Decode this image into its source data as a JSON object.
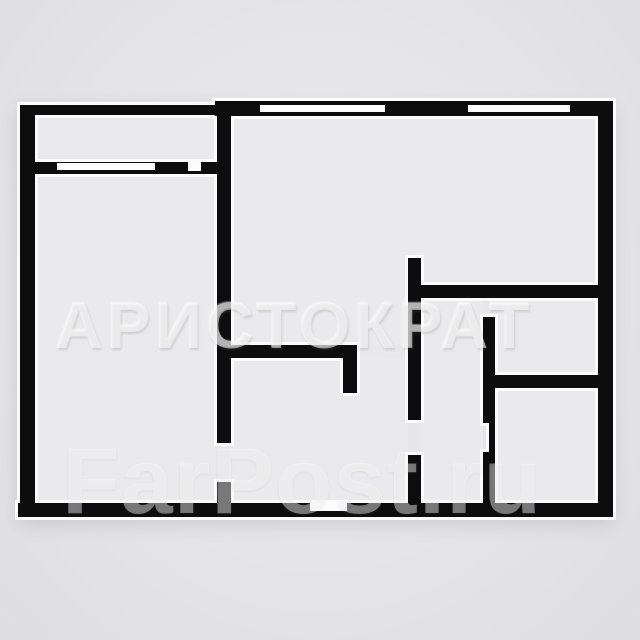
{
  "colors": {
    "page_bg": "#e4e4e6",
    "room_fill": "#eaeaec",
    "wall": "#0d0d0d",
    "halo": "#fbfbfc",
    "opening_fill": "#fcfcfd"
  },
  "watermarks": {
    "brand": "АРИСТОКРАТ",
    "site": "FarPost.ru"
  },
  "floorplan": {
    "rooms": [
      {
        "name": "room-balcony",
        "x": 35,
        "y": 115,
        "w": 183,
        "h": 47
      },
      {
        "name": "room-left",
        "x": 34,
        "y": 174,
        "w": 183,
        "h": 329
      },
      {
        "name": "room-living-top",
        "x": 231,
        "y": 116,
        "w": 367,
        "h": 170
      },
      {
        "name": "room-living-left",
        "x": 231,
        "y": 116,
        "w": 177,
        "h": 229
      },
      {
        "name": "room-corridor",
        "x": 231,
        "y": 358,
        "w": 177,
        "h": 145
      },
      {
        "name": "room-inner-hall",
        "x": 421,
        "y": 297,
        "w": 62,
        "h": 206
      },
      {
        "name": "room-bathroom",
        "x": 495,
        "y": 297,
        "w": 103,
        "h": 78
      },
      {
        "name": "room-bottom-right",
        "x": 495,
        "y": 388,
        "w": 103,
        "h": 115
      }
    ],
    "walls": [
      {
        "name": "balcony-parapet-wall",
        "x": 22,
        "y": 105,
        "w": 196,
        "h": 10
      },
      {
        "name": "left-outer-wall",
        "x": 20,
        "y": 105,
        "w": 15,
        "h": 412
      },
      {
        "name": "balcony-inner-wall",
        "x": 22,
        "y": 162,
        "w": 196,
        "h": 12
      },
      {
        "name": "top-outer-wall",
        "x": 215,
        "y": 101,
        "w": 398,
        "h": 15
      },
      {
        "name": "right-outer-wall",
        "x": 598,
        "y": 101,
        "w": 15,
        "h": 416
      },
      {
        "name": "bottom-outer-wall",
        "x": 18,
        "y": 503,
        "w": 595,
        "h": 14
      },
      {
        "name": "center-wall-upper",
        "x": 217,
        "y": 115,
        "w": 14,
        "h": 328
      },
      {
        "name": "center-wall-lower",
        "x": 217,
        "y": 482,
        "w": 14,
        "h": 28
      },
      {
        "name": "corridor-wall-horizontal",
        "x": 231,
        "y": 345,
        "w": 126,
        "h": 13
      },
      {
        "name": "corridor-wall-return",
        "x": 343,
        "y": 358,
        "w": 14,
        "h": 35
      },
      {
        "name": "inner-wall-right-upper",
        "x": 408,
        "y": 258,
        "w": 13,
        "h": 162
      },
      {
        "name": "inner-wall-right-lower",
        "x": 408,
        "y": 455,
        "w": 13,
        "h": 52
      },
      {
        "name": "bathroom-wall-top",
        "x": 415,
        "y": 285,
        "w": 184,
        "h": 13
      },
      {
        "name": "bathroom-wall-bottom",
        "x": 493,
        "y": 375,
        "w": 106,
        "h": 13
      },
      {
        "name": "bathroom-wall-left-upper",
        "x": 483,
        "y": 317,
        "w": 12,
        "h": 106
      },
      {
        "name": "bathroom-door-jamb",
        "x": 489,
        "y": 423,
        "w": 6,
        "h": 29
      },
      {
        "name": "bathroom-wall-left-lower",
        "x": 483,
        "y": 452,
        "w": 12,
        "h": 55
      }
    ],
    "openings": [
      {
        "name": "balcony-window",
        "x": 57,
        "y": 163,
        "w": 98,
        "h": 7
      },
      {
        "name": "balcony-door-opening",
        "x": 188,
        "y": 162,
        "w": 13,
        "h": 9
      },
      {
        "name": "window-living-room",
        "x": 260,
        "y": 105,
        "w": 125,
        "h": 7
      },
      {
        "name": "window-right-room",
        "x": 468,
        "y": 105,
        "w": 102,
        "h": 7
      },
      {
        "name": "entry-door-opening",
        "x": 310,
        "y": 503,
        "w": 37,
        "h": 8
      }
    ]
  }
}
